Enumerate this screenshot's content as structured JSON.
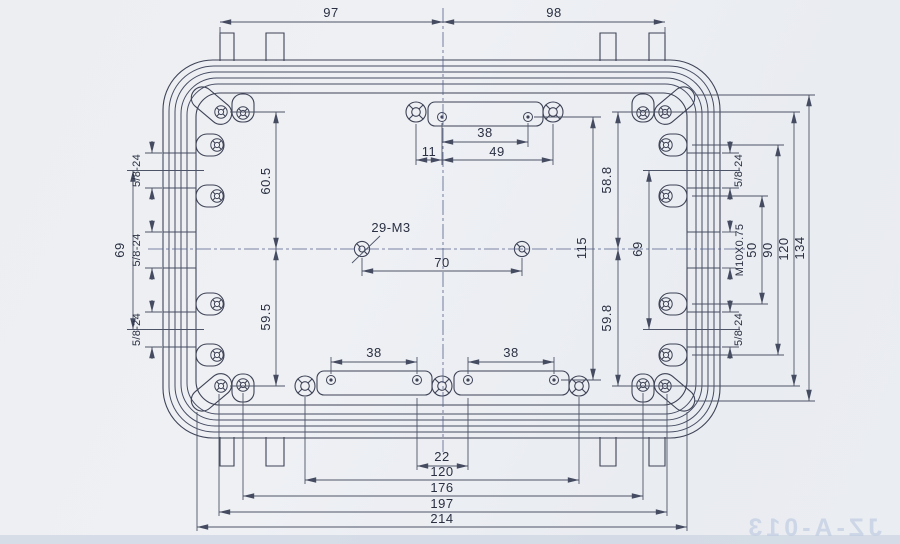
{
  "drawing": {
    "watermark": "JZ-A-013",
    "dims": {
      "top": {
        "left": "97",
        "right": "98"
      },
      "top_slot": {
        "holes": "38",
        "offset": "11",
        "span": "49"
      },
      "left": {
        "upper": "60.5",
        "lower": "59.5",
        "pitch": "69"
      },
      "right": {
        "upper": "58.8",
        "lower": "59.8",
        "pitch": "69",
        "slot_rows": "115",
        "ears_inner": "50",
        "ears_outer": "90",
        "corners": "120",
        "overall": "134"
      },
      "center": {
        "note": "29-M3",
        "span": "70"
      },
      "bottom": {
        "slot_left": "38",
        "slot_right": "38",
        "gap": "22",
        "flanks": "120",
        "mid": "176",
        "wide": "197",
        "overall": "214"
      },
      "threads": {
        "left_top": "5/8-24",
        "left_mid": "5/8-24",
        "left_bot": "5/8-24",
        "right_top": "5/8-24",
        "right_mid": "M10X0.75",
        "right_bot": "5/8-24"
      }
    }
  }
}
